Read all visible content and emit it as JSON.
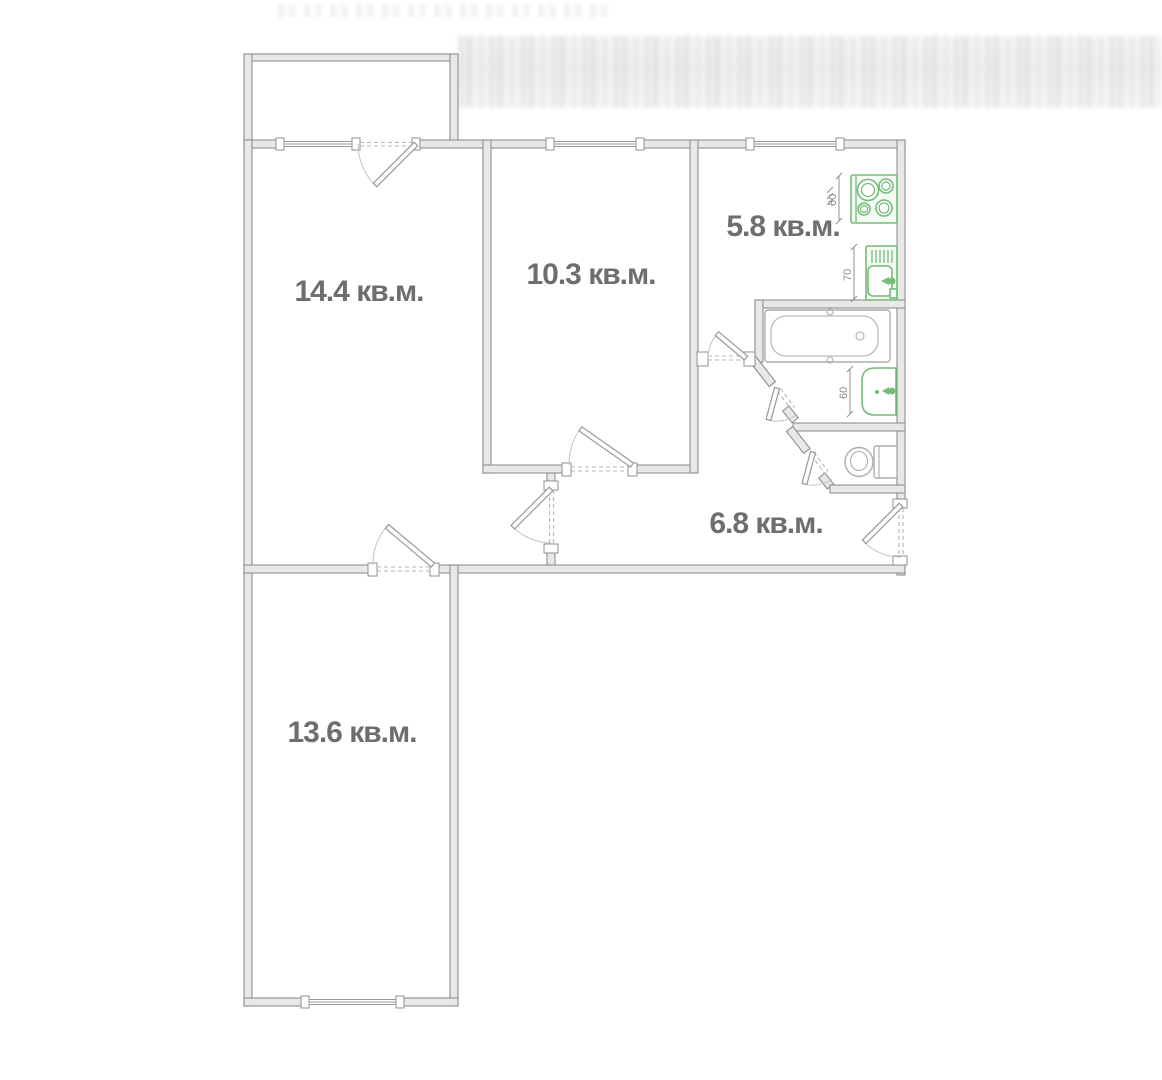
{
  "plan": {
    "type": "apartment-floor-plan",
    "rooms": [
      {
        "name": "living-room-1",
        "area_label": "14.4 кв.м."
      },
      {
        "name": "room-2",
        "area_label": "10.3 кв.м."
      },
      {
        "name": "kitchen",
        "area_label": "5.8 кв.м."
      },
      {
        "name": "hallway",
        "area_label": "6.8 кв.м."
      },
      {
        "name": "room-3",
        "area_label": "13.6 кв.м."
      }
    ],
    "fixture_dimensions": {
      "stove_width": "60",
      "kitchen_sink_width": "70",
      "washbasin_width": "60"
    },
    "fixtures": [
      "stove",
      "kitchen-sink",
      "bathtub",
      "washbasin",
      "toilet"
    ],
    "colors": {
      "fixture_green": "#74bc77",
      "wall_fill": "#e8e8e8",
      "wall_stroke": "#8f8f8f",
      "room_label_text": "#6e6e70",
      "dimension_text": "#8a8a8a"
    }
  }
}
